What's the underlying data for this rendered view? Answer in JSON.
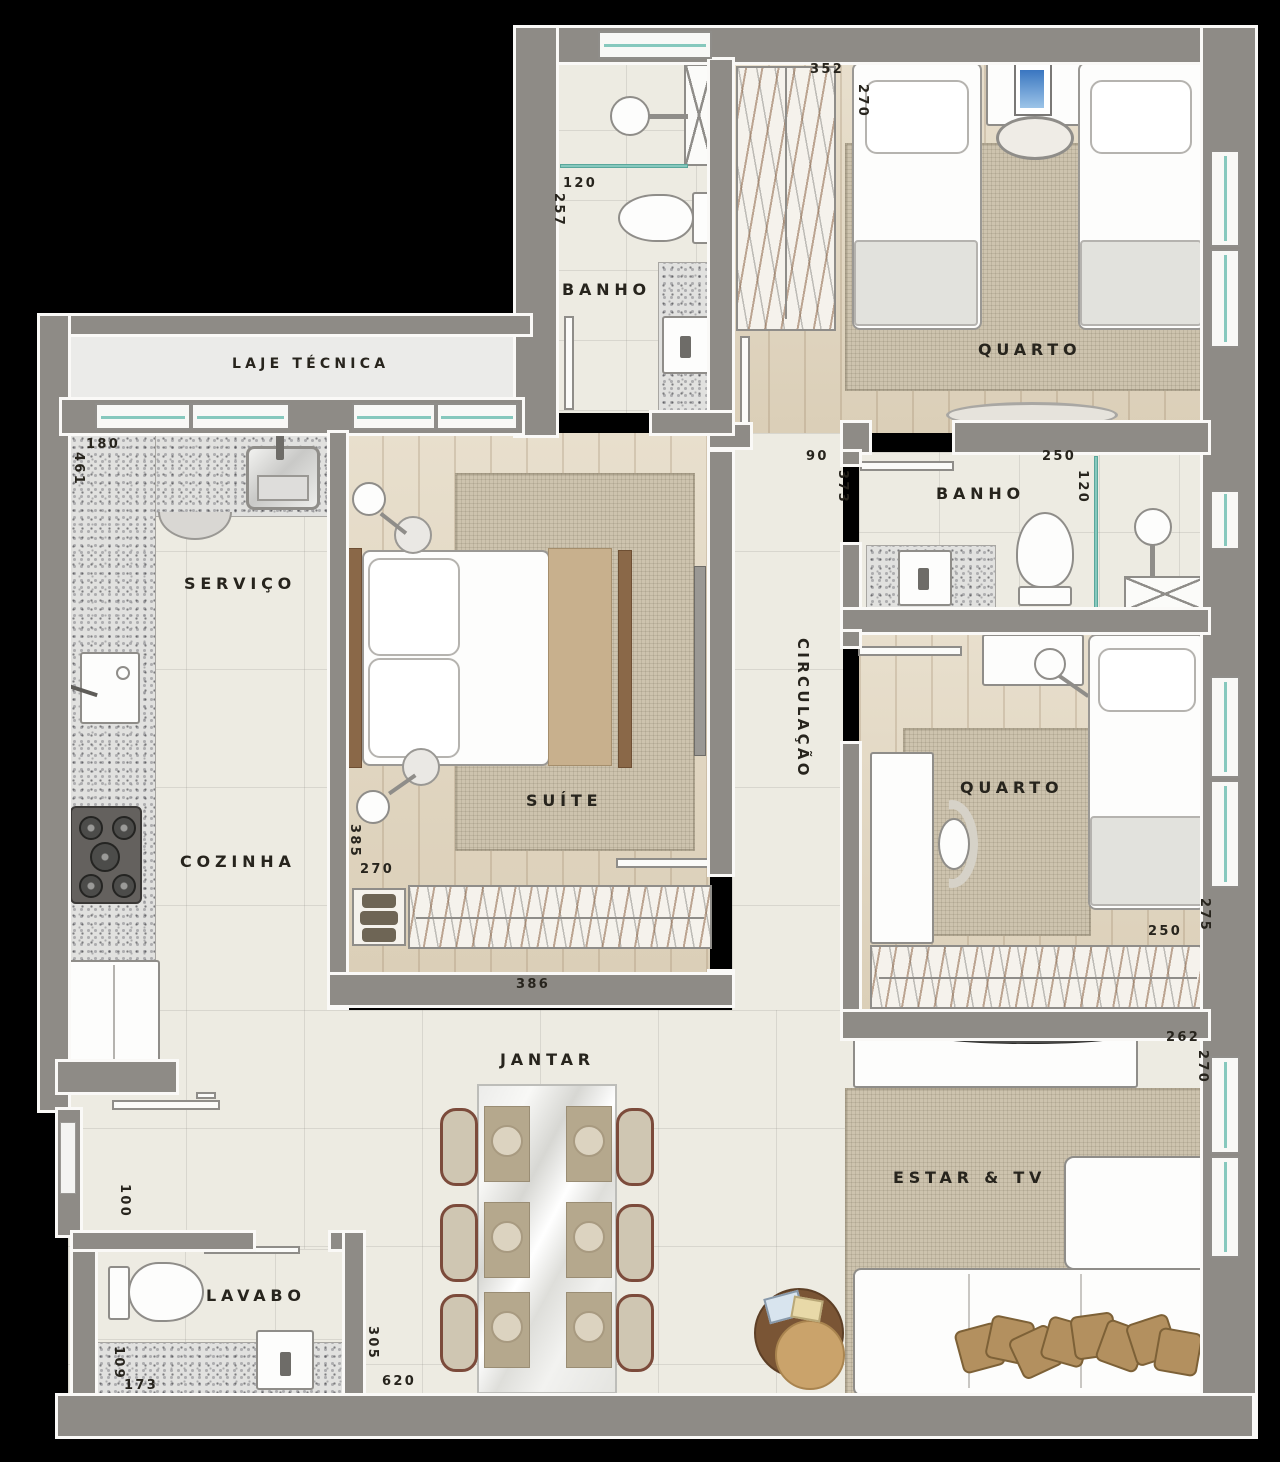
{
  "title": "Apartment floor plan",
  "rooms": {
    "laje_tecnica": "LAJE TÉCNICA",
    "servico": "SERVIÇO",
    "cozinha": "COZINHA",
    "banho_suite": "BANHO",
    "quarto_top": "QUARTO",
    "banho_social": "BANHO",
    "circulacao": "CIRCULAÇÃO",
    "suite": "SUÍTE",
    "quarto_lower": "QUARTO",
    "jantar": "JANTAR",
    "lavabo": "LAVABO",
    "estar_tv": "ESTAR & TV"
  },
  "dimensions_cm": {
    "banho_suite_w": "120",
    "banho_suite_h": "257",
    "quarto_top_w": "352",
    "quarto_top_h": "270",
    "servico_w": "180",
    "servico_h": "461",
    "circulacao_w": "90",
    "circulacao_h": "373",
    "banho_social_w": "250",
    "banho_social_h": "120",
    "suite_h": "385",
    "suite_w": "270",
    "suite_door_w": "386",
    "quarto_lower_w": "250",
    "quarto_lower_h": "275",
    "estar_w": "262",
    "estar_h": "270",
    "entry_h": "100",
    "lavabo_h": "109",
    "lavabo_w": "173",
    "jantar_h": "305",
    "jantar_w": "620"
  },
  "colors": {
    "background": "#000000",
    "wall": "#8e8b86",
    "wall_outline": "#faf9f7",
    "glass": "#86c8bd",
    "floor_tile": "#edebe2",
    "floor_wood": "#e3d8c2",
    "granite": "#e1e1df",
    "rug": "#cdc3ae",
    "label_text": "#27241d",
    "wood_furniture": "#8a6848",
    "cushion": "#b3905f"
  }
}
